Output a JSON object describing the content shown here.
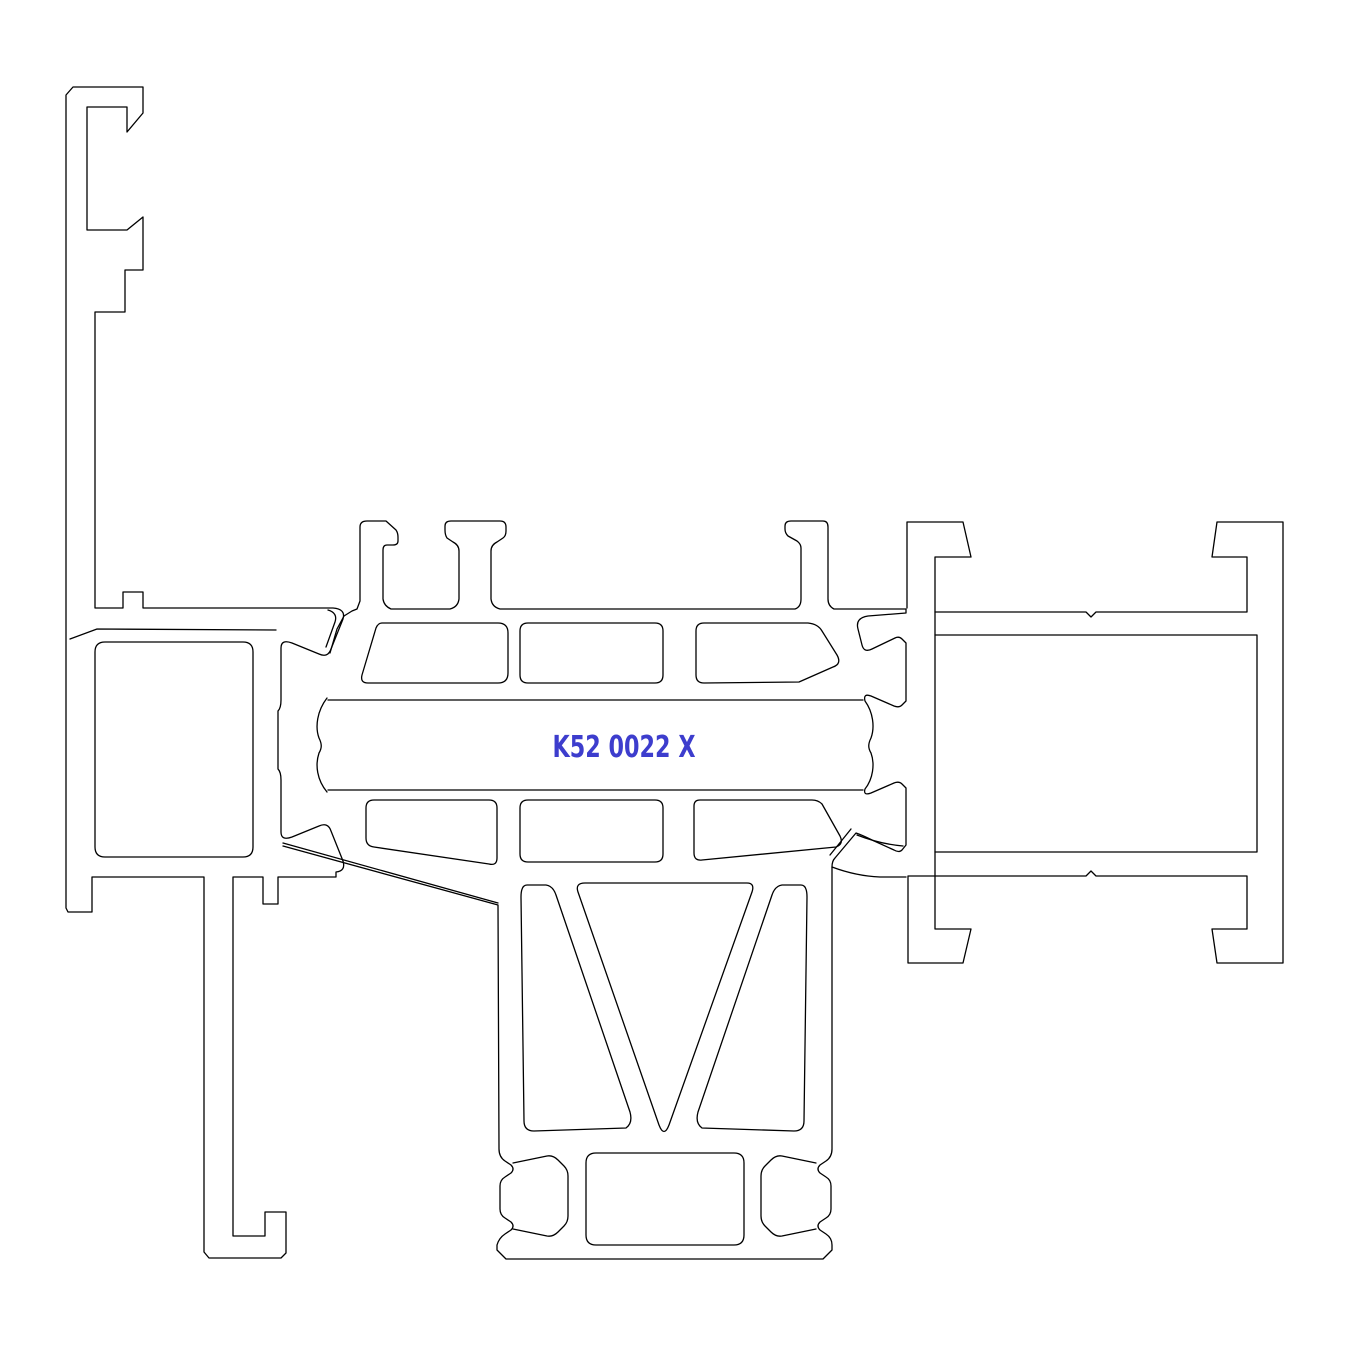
{
  "drawing": {
    "type": "cad-profile-cross-section",
    "label": "K52 0022 X",
    "label_color": "#3d3dcd",
    "line_color": "#000000",
    "background_color": "#ffffff",
    "parts": {
      "left": "glazing-bead-and-outer-frame-profile",
      "middle": "thermally-broken-sash-profile",
      "right": "mullion-frame-profile",
      "bottom": "sash-bottom-rail-profile"
    }
  }
}
